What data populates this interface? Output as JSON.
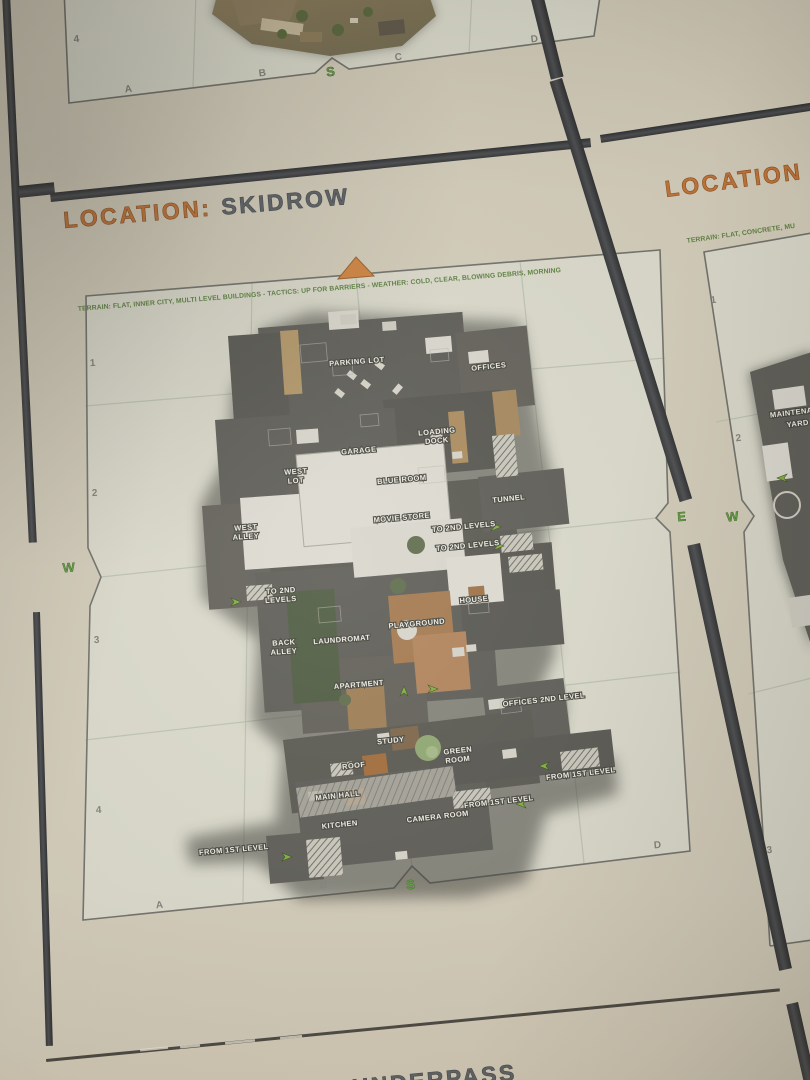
{
  "colors": {
    "accent_orange": "#bf7338",
    "compass_green": "#5f9e3f",
    "title_gray": "#5d6164",
    "paper": "#d2cbb9",
    "panel_interior": "#d9d8ca",
    "gutter_dark": "#37383a",
    "map_dark": "#5c5b55"
  },
  "top_panel": {
    "row_label": "4",
    "col_labels": [
      "A",
      "B",
      "C",
      "D"
    ],
    "compass_south": "S"
  },
  "skidrow": {
    "title_prefix": "LOCATION:",
    "title_name": "SKIDROW",
    "info_line": "TERRAIN: FLAT, INNER CITY, MULTI LEVEL BUILDINGS - TACTICS: UP FOR BARRIERS - WEATHER: COLD, CLEAR, BLOWING DEBRIS, MORNING",
    "row_labels": [
      "1",
      "2",
      "3",
      "4"
    ],
    "col_labels": [
      "A",
      "B",
      "C",
      "D"
    ],
    "compass": {
      "west": "W",
      "east": "E",
      "south": "S"
    },
    "labels": [
      "PARKING LOT",
      "OFFICES",
      "LOADING",
      "DOCK",
      "GARAGE",
      "WEST",
      "LOT",
      "BLUE ROOM",
      "TUNNEL",
      "MOVIE STORE",
      "TO 2ND LEVELS",
      "TO 2ND LEVELS",
      "WEST",
      "ALLEY",
      "TO 2ND",
      "LEVELS",
      "HOUSE",
      "PLAYGROUND",
      "BACK",
      "ALLEY",
      "LAUNDROMAT",
      "APARTMENT",
      "OFFICES 2ND LEVEL",
      "STUDY",
      "GREEN",
      "ROOM",
      "ROOF",
      "FROM 1ST LEVEL",
      "MAIN HALL",
      "FROM 1ST LEVEL",
      "KITCHEN",
      "CAMERA ROOM",
      "FROM 1ST LEVEL"
    ]
  },
  "right_panel": {
    "title": "LOCATION",
    "info_line": "TERRAIN: FLAT, CONCRETE, MU",
    "row_labels": [
      "1",
      "2",
      "3"
    ],
    "compass_west": "W",
    "map_label_line1": "MAINTENANCE",
    "map_label_line2": "YARD"
  },
  "bottom_panel": {
    "title_prefix": "LOCATION:",
    "title_name": "UNDERPASS"
  }
}
